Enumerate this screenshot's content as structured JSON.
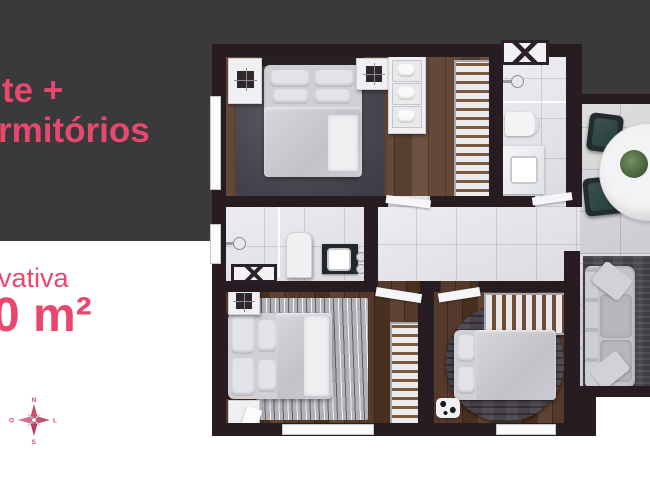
{
  "panel": {
    "headline_line1": "te +",
    "headline_line2": "rmitórios",
    "area_label": "vativa",
    "area_value": "0 m²"
  },
  "compass": {
    "north": "N",
    "east": "L",
    "south": "S",
    "west": "O"
  },
  "colors": {
    "accent_pink": "#e8486e",
    "panel_background": "#3a393b",
    "wall": "#261c22",
    "wood_floor": "#5e4736",
    "tile_floor": "#e2e2e6",
    "page_background": "#ffffff"
  }
}
